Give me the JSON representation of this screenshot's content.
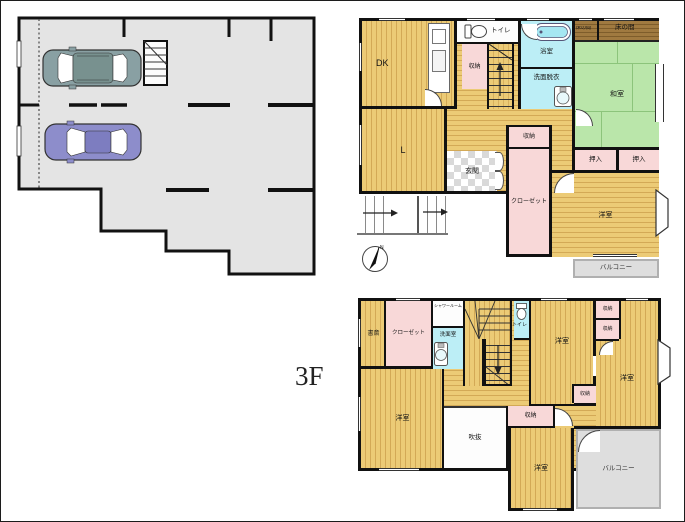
{
  "annotations": {
    "floor3_label": "3F",
    "compass_north": "N"
  },
  "floor2": {
    "dk": "DK",
    "living": "L",
    "toilet": "トイレ",
    "storage_top": "収納",
    "bath": "浴室",
    "washroom": "洗面脱衣",
    "tokonoma_left": "床の間",
    "tokonoma_right": "床の間",
    "washitsu": "和室",
    "oshiire_left": "押入",
    "oshiire_right": "押入",
    "storage_mid": "収納",
    "closet": "クローゼット",
    "genkan": "玄関",
    "youshitsu": "洋室",
    "balcony": "バルコニー"
  },
  "floor3": {
    "study": "書斎",
    "closet": "クローゼット",
    "shower": "シャワールーム",
    "washroom": "洗面室",
    "toilet": "トイレ",
    "youshitsu_mid": "洋室",
    "storage_right_1": "収納",
    "storage_right_2": "収納",
    "youshitsu_right": "洋室",
    "storage_small": "収納",
    "youshitsu_left": "洋室",
    "fukinuke": "吹抜",
    "storage_center": "収納",
    "youshitsu_bottom": "洋室",
    "balcony": "バルコニー"
  },
  "colors": {
    "wall": "#111111",
    "wood": "#eccb76",
    "tatami": "#bae6aa",
    "closet_pink": "#f8d8d8",
    "wet_cyan": "#bceef6",
    "tokonoma_brown": "#a07a40",
    "garage_gray": "#e4e4e4",
    "balcony_gray": "#dedede",
    "suv_body": "#89a0a3",
    "sedan_body": "#8d8dcb"
  }
}
